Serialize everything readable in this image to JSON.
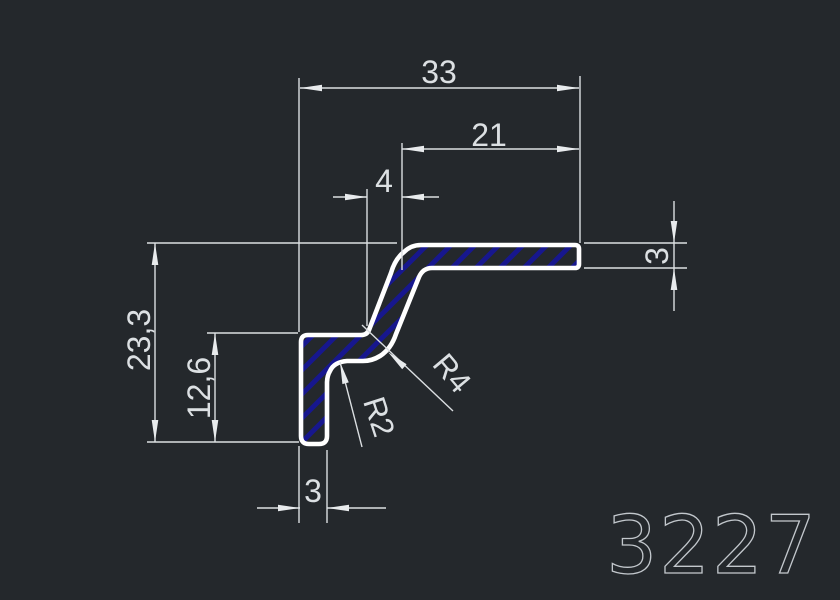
{
  "drawing": {
    "part_number": "3227",
    "dimensions": {
      "total_width": "33",
      "flange_width": "21",
      "step_width": "4",
      "flange_thickness": "3",
      "total_height": "23,3",
      "leg_height": "12,6",
      "leg_thickness": "3",
      "radius_outer": "R4",
      "radius_inner": "R2"
    },
    "colors": {
      "background": "#24282c",
      "profile_outline": "#ffffff",
      "hatch": "#17178e",
      "dimension_lines": "#dbdfe2",
      "dimension_text": "#dce0e3",
      "part_number_color": "#c2c7cc"
    }
  }
}
